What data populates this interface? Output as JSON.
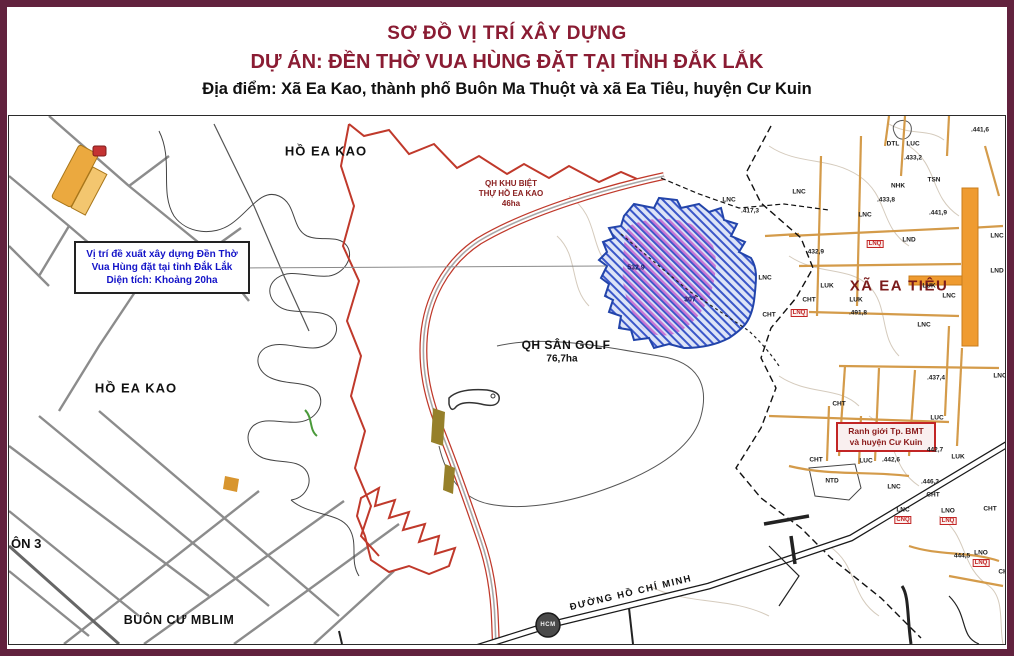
{
  "title": {
    "line1": "SƠ ĐỒ VỊ TRÍ XÂY DỰNG",
    "line2": "DỰ ÁN: ĐỀN THỜ VUA HÙNG ĐẶT TẠI TỈNH ĐẮK LẮK",
    "line3": "Địa điểm: Xã Ea Kao, thành phố Buôn Ma Thuột và xã Ea Tiêu, huyện Cư Kuin"
  },
  "annotation_box": {
    "line1": "Vị trí đề xuất xây dựng Đền Thờ",
    "line2": "Vua Hùng đặt tại tỉnh Đắk Lắk",
    "line3": "Diện tích: Khoảng 20ha"
  },
  "map_labels": {
    "ho_ea_kao_top": "HỒ EA KAO",
    "ho_ea_kao_left": "HỒ EA KAO",
    "qh_biet_thu_l1": "QH KHU BIỆT",
    "qh_biet_thu_l2": "THỰ HỒ EA KAO",
    "qh_biet_thu_l3": "46ha",
    "qh_san_golf": "QH SÂN GOLF",
    "qh_san_golf_area": "76,7ha",
    "xa_ea_tieu": "XÃ EA TIÊU",
    "boundary_box_l1": "Ranh giới Tp. BMT",
    "boundary_box_l2": "và huyện Cư Kuin",
    "buon_cu_mblim": "BUÔN CƯ MBLIM",
    "thon3": "ÔN 3",
    "duong_hcm": "ĐƯỜNG HỒ CHÍ MINH",
    "hcm_badge": "HCM",
    "site_elev": "532,9",
    "site_code": "307"
  },
  "small_labels": [
    {
      "t": "DTL",
      "x": 884,
      "y": 28,
      "c": "k"
    },
    {
      "t": "LUC",
      "x": 904,
      "y": 28,
      "c": "k"
    },
    {
      "t": ".433,2",
      "x": 904,
      "y": 42,
      "c": "k"
    },
    {
      "t": ".441,6",
      "x": 971,
      "y": 14,
      "c": "k"
    },
    {
      "t": "NHK",
      "x": 889,
      "y": 70,
      "c": "k"
    },
    {
      "t": ".433,8",
      "x": 877,
      "y": 84,
      "c": "k"
    },
    {
      "t": "TSN",
      "x": 925,
      "y": 64,
      "c": "k"
    },
    {
      "t": ".441,9",
      "x": 929,
      "y": 97,
      "c": "k"
    },
    {
      "t": "LNC",
      "x": 790,
      "y": 76,
      "c": "k"
    },
    {
      "t": ".417,3",
      "x": 741,
      "y": 95,
      "c": "k"
    },
    {
      "t": "LNC",
      "x": 856,
      "y": 99,
      "c": "k"
    },
    {
      "t": "LND",
      "x": 900,
      "y": 124,
      "c": "k"
    },
    {
      "t": "LNQ",
      "x": 866,
      "y": 128,
      "c": "rb"
    },
    {
      "t": "LNC",
      "x": 988,
      "y": 120,
      "c": "k"
    },
    {
      "t": "LND",
      "x": 988,
      "y": 155,
      "c": "k"
    },
    {
      "t": ".432,9",
      "x": 806,
      "y": 136,
      "c": "k"
    },
    {
      "t": "LNC",
      "x": 756,
      "y": 162,
      "c": "k"
    },
    {
      "t": "LNC",
      "x": 720,
      "y": 84,
      "c": "k"
    },
    {
      "t": "LUK",
      "x": 818,
      "y": 170,
      "c": "k"
    },
    {
      "t": "CHT",
      "x": 800,
      "y": 184,
      "c": "k"
    },
    {
      "t": "LNQ",
      "x": 790,
      "y": 197,
      "c": "rb"
    },
    {
      "t": "LUK",
      "x": 847,
      "y": 184,
      "c": "k"
    },
    {
      "t": ".491,8",
      "x": 849,
      "y": 197,
      "c": "k"
    },
    {
      "t": "LNC",
      "x": 915,
      "y": 209,
      "c": "k"
    },
    {
      "t": "LNC",
      "x": 991,
      "y": 260,
      "c": "k"
    },
    {
      "t": "LUK",
      "x": 920,
      "y": 170,
      "c": "k"
    },
    {
      "t": "LNC",
      "x": 940,
      "y": 180,
      "c": "k"
    },
    {
      "t": ".437,4",
      "x": 927,
      "y": 262,
      "c": "k"
    },
    {
      "t": "CHT",
      "x": 830,
      "y": 288,
      "c": "k"
    },
    {
      "t": "CHT",
      "x": 760,
      "y": 199,
      "c": "k"
    },
    {
      "t": "LUC",
      "x": 928,
      "y": 302,
      "c": "k"
    },
    {
      "t": "442,7",
      "x": 926,
      "y": 334,
      "c": "k"
    },
    {
      "t": "LUK",
      "x": 949,
      "y": 341,
      "c": "k"
    },
    {
      "t": "CHT",
      "x": 807,
      "y": 344,
      "c": "k"
    },
    {
      "t": "LUC",
      "x": 857,
      "y": 345,
      "c": "k"
    },
    {
      "t": ".442,6",
      "x": 882,
      "y": 344,
      "c": "k"
    },
    {
      "t": "NTD",
      "x": 823,
      "y": 365,
      "c": "k"
    },
    {
      "t": "LNC",
      "x": 885,
      "y": 371,
      "c": "k"
    },
    {
      "t": ".446,3",
      "x": 921,
      "y": 366,
      "c": "k"
    },
    {
      "t": "CHT",
      "x": 924,
      "y": 379,
      "c": "k"
    },
    {
      "t": "LNC",
      "x": 894,
      "y": 394,
      "c": "k"
    },
    {
      "t": "CNQ",
      "x": 894,
      "y": 404,
      "c": "rb"
    },
    {
      "t": "LNO",
      "x": 939,
      "y": 395,
      "c": "k"
    },
    {
      "t": "LNQ",
      "x": 939,
      "y": 405,
      "c": "rb"
    },
    {
      "t": "CHT",
      "x": 981,
      "y": 393,
      "c": "k"
    },
    {
      "t": "444,5",
      "x": 953,
      "y": 440,
      "c": "k"
    },
    {
      "t": "LNO",
      "x": 972,
      "y": 437,
      "c": "k"
    },
    {
      "t": "LNQ",
      "x": 972,
      "y": 447,
      "c": "rb"
    },
    {
      "t": "CHT",
      "x": 996,
      "y": 456,
      "c": "k"
    }
  ],
  "colors": {
    "frame": "#62223e",
    "title_red": "#8a1c33",
    "annotation_blue": "#1414c8",
    "plan_boundary_red": "#c0392b",
    "site_hatch_blue": "#3a57c9",
    "site_hatch_purple": "#c050c8",
    "road_orange": "#e8962e",
    "road_tan": "#d49b4a",
    "boundary_box_red": "#c22525"
  }
}
